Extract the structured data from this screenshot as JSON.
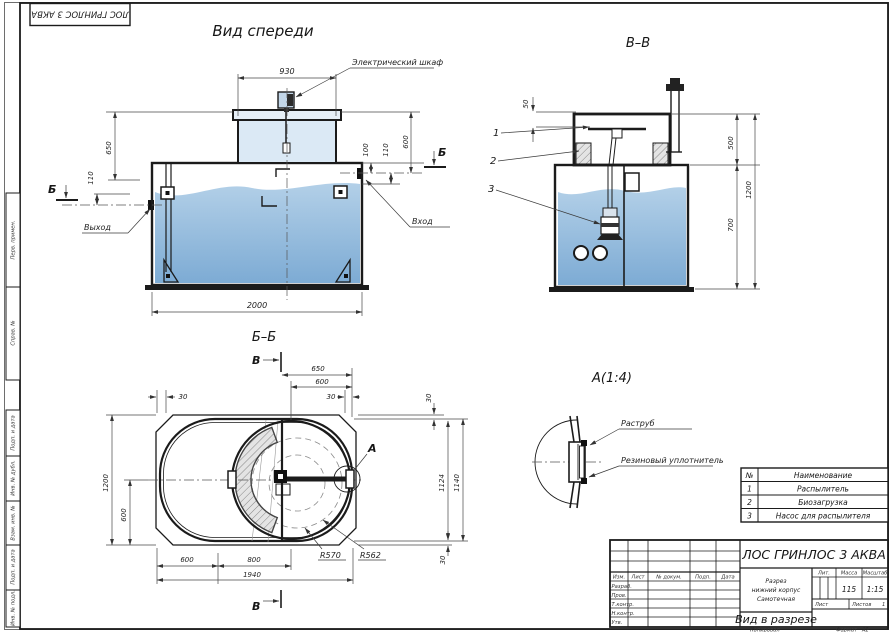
{
  "sheet": {
    "stamp_top_left": "ЛОС ГРИНЛОС 3 АКВА",
    "side_cells": [
      "Перв. примен.",
      "Справ. №",
      "Подп. и дата",
      "Инв. № дубл.",
      "Взам. инв. №",
      "Подп. и дата",
      "Инв. № подл."
    ],
    "footer": {
      "copied": "Копировал",
      "format_label": "Формат",
      "format_value": "А2"
    }
  },
  "front_view": {
    "title": "Вид спереди",
    "labels": {
      "cabinet": "Электрический шкаф",
      "outlet": "Выход",
      "inlet": "Вход",
      "section": "Б"
    },
    "dims": {
      "w930": "930",
      "d100": "100",
      "d110_right": "110",
      "d600": "600",
      "d650": "650",
      "d110_left": "110",
      "w2000": "2000"
    }
  },
  "section_vv": {
    "title": "В–В",
    "callouts": [
      "1",
      "2",
      "3"
    ],
    "dims": {
      "d50": "50",
      "d500": "500",
      "d700": "700",
      "d1200": "1200"
    }
  },
  "plan_bb": {
    "title": "Б–Б",
    "marker": "В",
    "detail": "А",
    "dims": {
      "d650": "650",
      "d600_top": "600",
      "d30_tl": "30",
      "d30_tr": "30",
      "d30_right": "30",
      "d1200": "1200",
      "d600_left": "600",
      "d600_bot": "600",
      "d800": "800",
      "d1940": "1940",
      "r570": "R570",
      "r562": "R562",
      "d1124": "1124",
      "d1140": "1140",
      "d30_br": "30"
    }
  },
  "detail_a": {
    "title": "А(1:4)",
    "labels": {
      "socket": "Раструб",
      "seal": "Резиновый уплотнитель"
    }
  },
  "parts_table": {
    "headers": {
      "num": "№",
      "name": "Наименование"
    },
    "rows": [
      {
        "num": "1",
        "name": "Распылитель"
      },
      {
        "num": "2",
        "name": "Биозагрузка"
      },
      {
        "num": "3",
        "name": "Насос для распылителя"
      }
    ]
  },
  "title_block": {
    "product": "ЛОС ГРИНЛОС 3 АКВА",
    "doc_lines": [
      "Разрез",
      "нижний корпус",
      "Самотечная"
    ],
    "view_name": "Вид в разрезе",
    "columns": {
      "izm": "Изм.",
      "list": "Лист",
      "doc": "№ докум.",
      "podp": "Подп.",
      "data": "Дата"
    },
    "roles": [
      "Разраб.",
      "Пров.",
      "Т.контр.",
      "Н.контр.",
      "Утв."
    ],
    "props": {
      "lit": "Лит.",
      "mass": "Масса",
      "scale": "Масштаб",
      "mass_value": "115",
      "scale_value": "1:15",
      "sheet_label": "Лист",
      "sheets_label": "Листов",
      "sheets_value": "1"
    }
  },
  "colors": {
    "water_top": "#b3d0e8",
    "water_bottom": "#7dabd4",
    "neck_fill": "#dbe9f5",
    "line": "#1b1b1b"
  }
}
